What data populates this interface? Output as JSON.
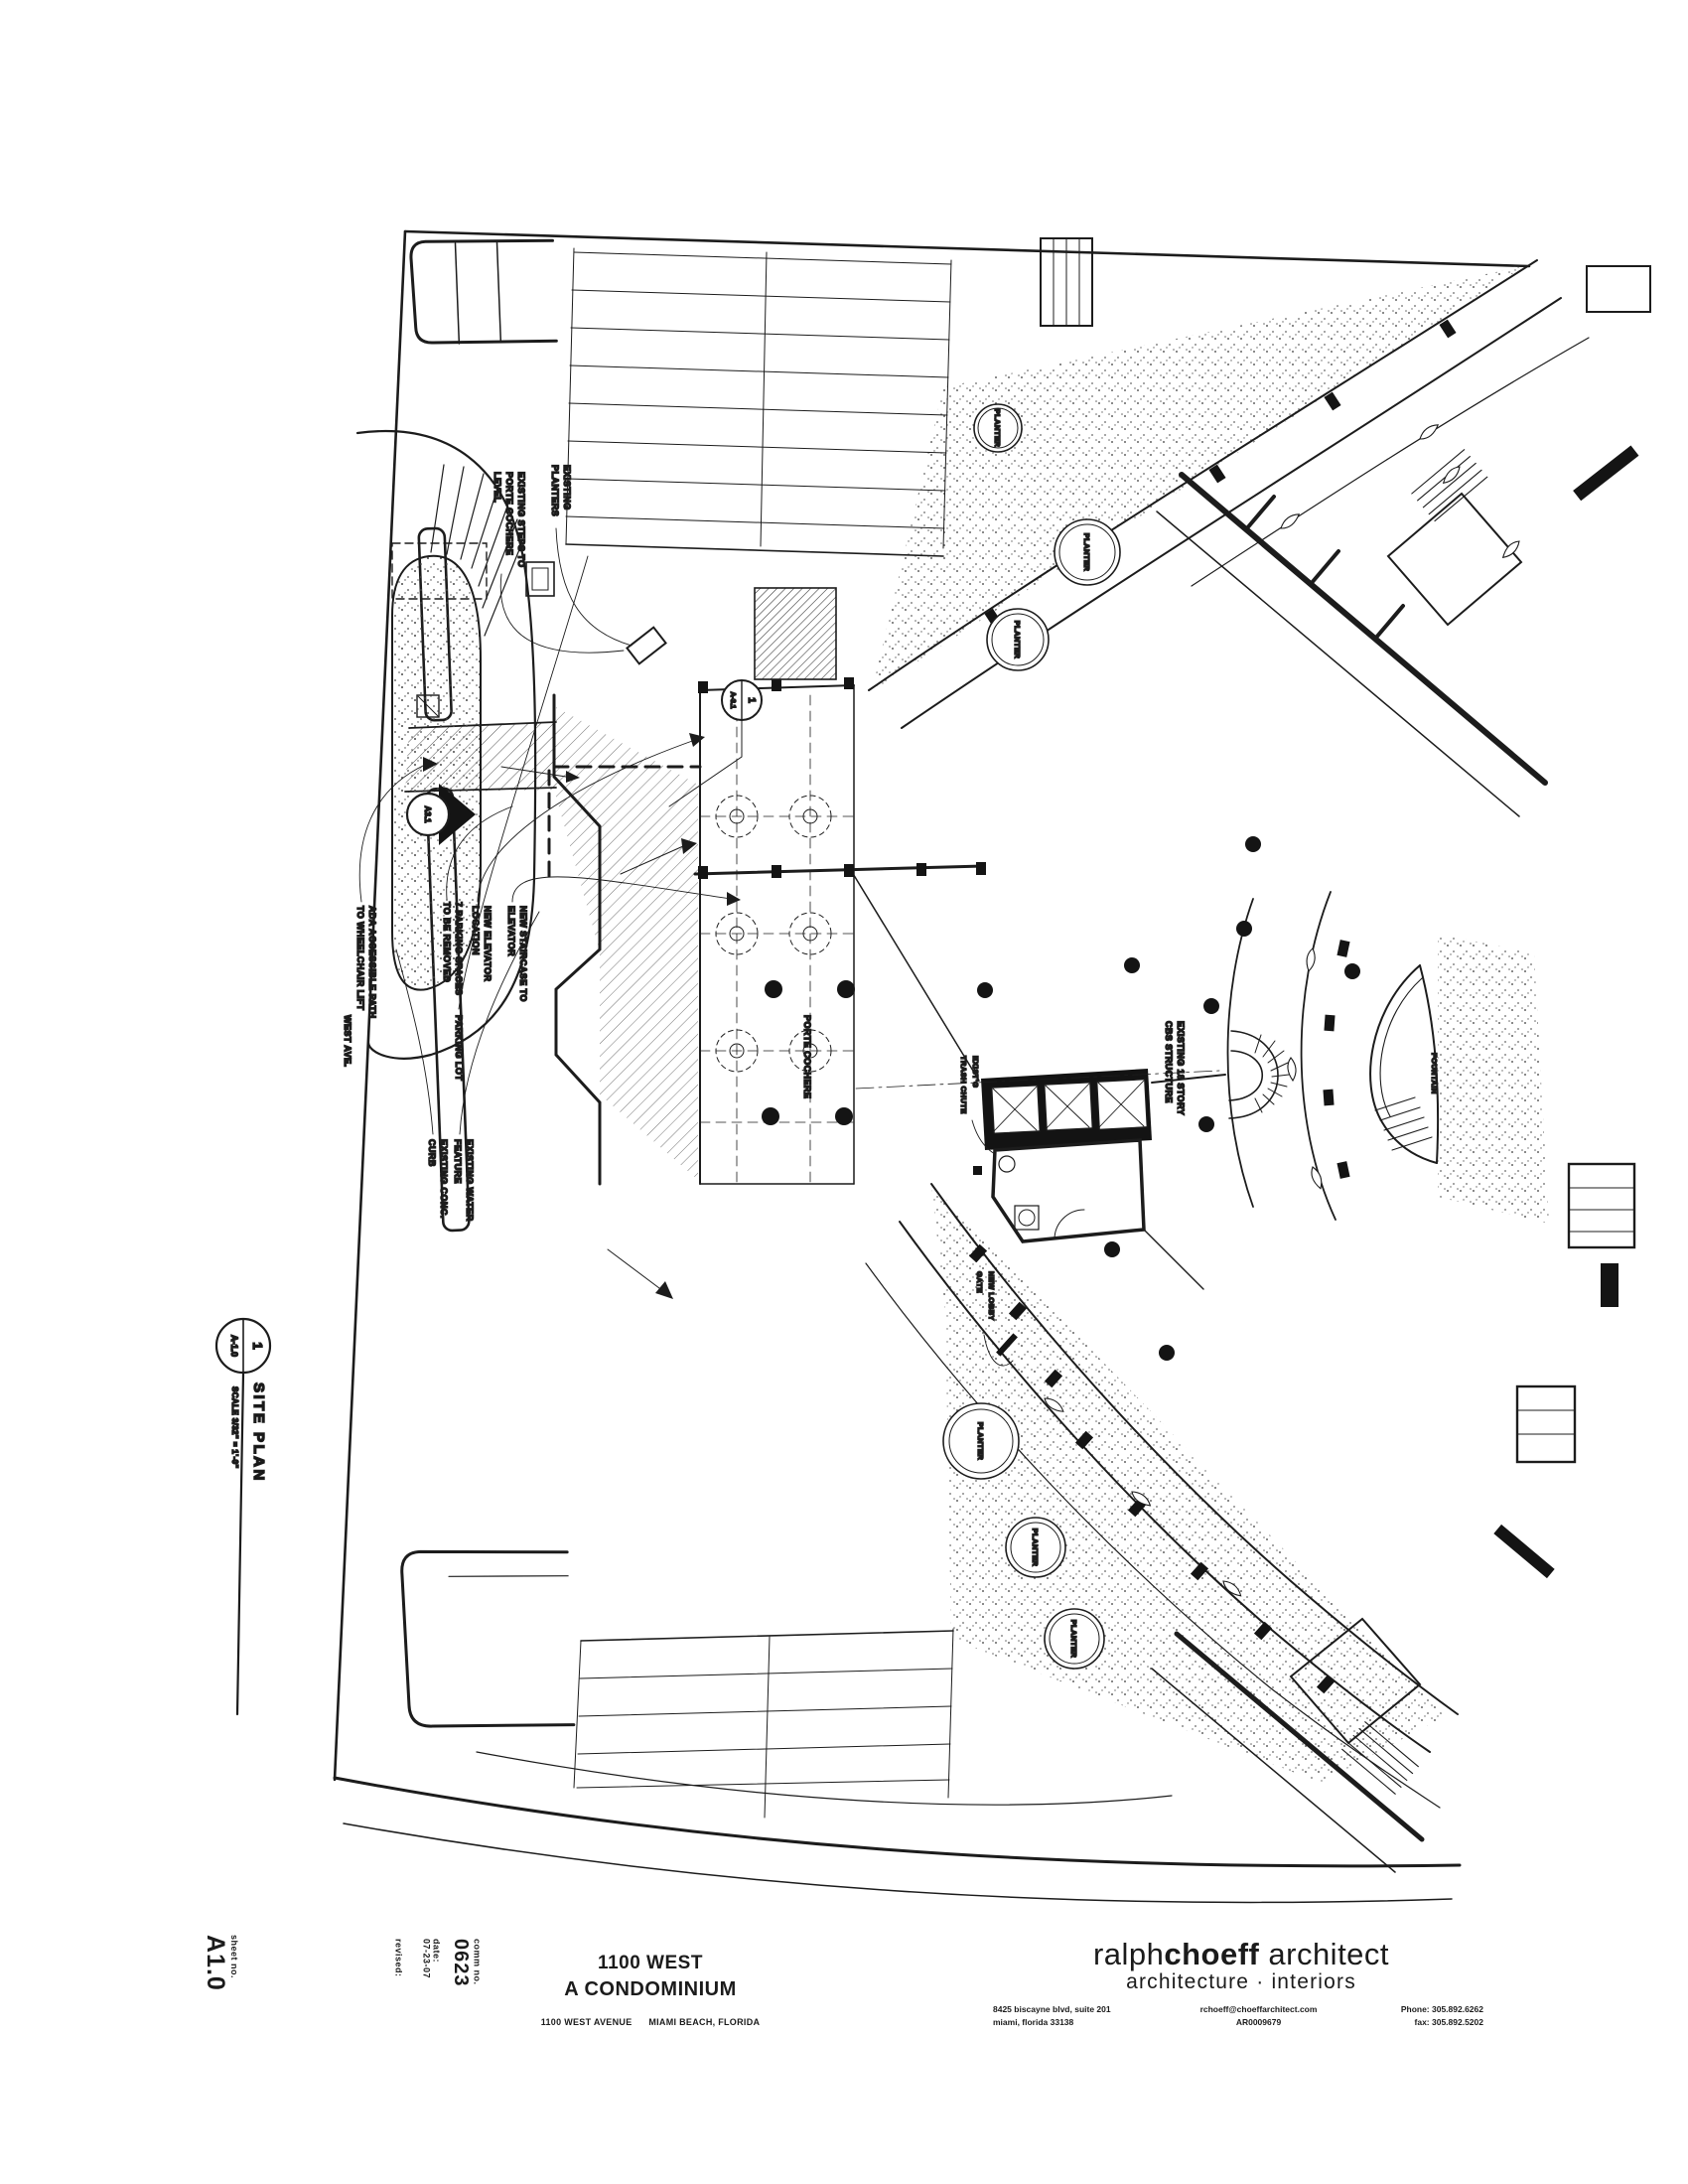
{
  "page": {
    "background": "#ffffff",
    "ink": "#1b1b1b"
  },
  "title_block": {
    "project_name_line1": "1100 WEST",
    "project_name_line2": "A CONDOMINIUM",
    "project_address": "1100 WEST AVENUE      MIAMI BEACH, FLORIDA",
    "firm": {
      "name_part1": "ralph",
      "name_part2": "choeff",
      "name_part3": "architect",
      "tagline": "architecture · interiors",
      "address_line1": "8425 biscayne blvd, suite 201",
      "address_line2": "miami, florida 33138",
      "email": "rchoeff@choeffarchitect.com",
      "license": "AR0009679",
      "phone": "Phone: 305.892.6262",
      "fax": "fax: 305.892.5202"
    },
    "comm_no_label": "comm no.",
    "comm_no_value": "0623",
    "date_label": "date:",
    "date_value": "07-23-07",
    "revised_label": "revised:",
    "sheet_no_label": "sheet no.",
    "sheet_no_value": "A1.0"
  },
  "drawing_title": {
    "bubble_number": "1",
    "bubble_sheet": "A-1.0",
    "title": "SITE PLAN",
    "scale": "SCALE  3/32\" = 1'-0\""
  },
  "markers": {
    "section_bubble": "A3.1",
    "detail_bubble_number": "1",
    "detail_bubble_sheet": "A-3.1"
  },
  "annotations": {
    "existing_planters": [
      "EXISTING",
      "PLANTERS"
    ],
    "existing_steps": [
      "EXISTING STEPS TO",
      "PORTE COCHERE",
      "LEVEL"
    ],
    "ada_path": [
      "ADA ACCESSIBLE PATH",
      "TO WHEELCHAIR LIFT"
    ],
    "west_ave": "WEST AVE.",
    "parking_removed": [
      "7 PARKING SPACES",
      "TO BE REMOVED"
    ],
    "new_elevator": [
      "NEW ELEVATOR",
      "LOCATION"
    ],
    "new_stairs": [
      "NEW STAIRCASE TO",
      "ELEVATOR"
    ],
    "parking_lot": "PARKING LOT",
    "conc_curb": [
      "EXISTING CONC.",
      "CURB"
    ],
    "water_feature": [
      "EXISTING WATER",
      "FEATURE"
    ],
    "porte_cochere": "PORTE COCHERE",
    "trash_chute": [
      "EXIST'G",
      "TRASH CHUTE"
    ],
    "lobby_gate": [
      "NEW LOBBY",
      "GATE"
    ],
    "existing_structure": [
      "EXISTING 18 STORY",
      "CBS STRUCTURE"
    ],
    "fountain": "FOUNTAIN",
    "planter": "PLANTER"
  }
}
